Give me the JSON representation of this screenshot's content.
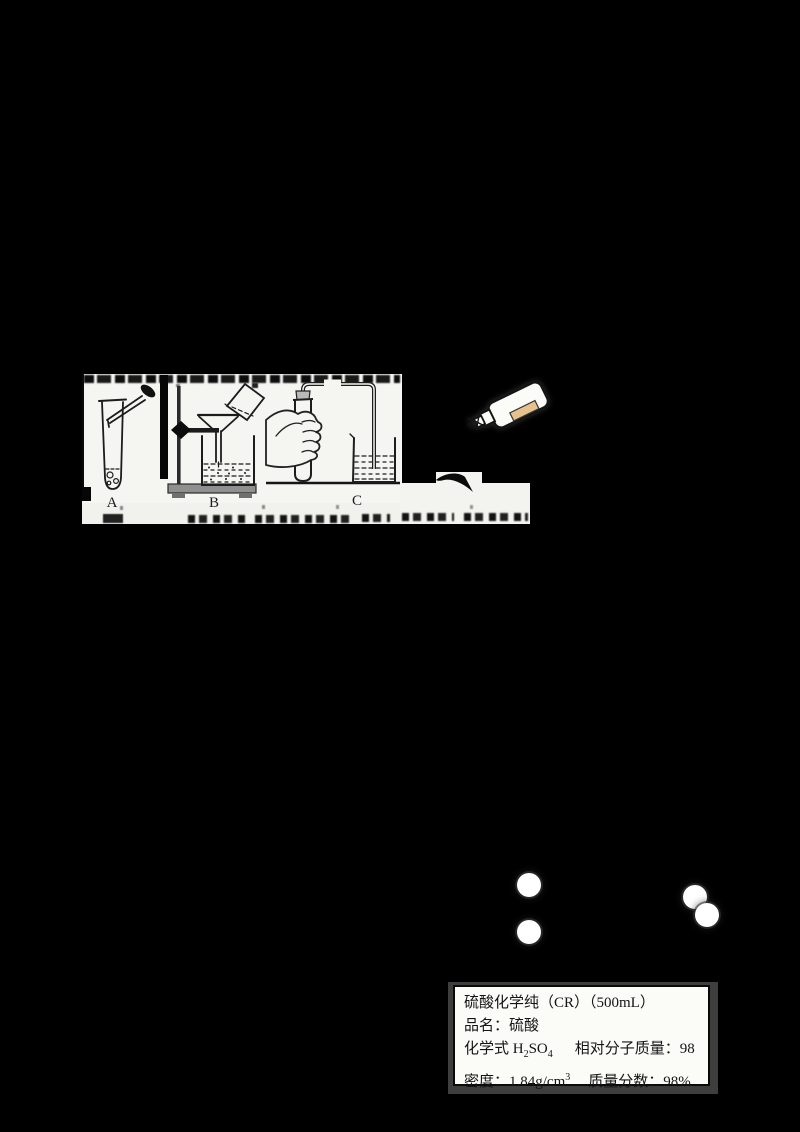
{
  "canvas": {
    "width": 800,
    "height": 1132,
    "background_color": "#000000",
    "paper_color": "#f5f5f2"
  },
  "experiment_figure": {
    "apparatus": [
      {
        "label": "A",
        "icon": "test-tube-with-dropper-icon"
      },
      {
        "label": "B",
        "icon": "filtration-funnel-stand-icon"
      },
      {
        "label": "C",
        "icon": "hand-warming-test-tube-airtightness-icon"
      }
    ]
  },
  "reagent_bottle_icon": {
    "body_color": "#fbfbf7",
    "label_color": "#e8c28d",
    "outline_color": "#141414"
  },
  "molecule_diagram": {
    "atom_color": "#ffffff",
    "atom_radius": 12,
    "atoms": [
      {
        "cx": 529,
        "cy": 885
      },
      {
        "cx": 529,
        "cy": 932
      },
      {
        "cx": 695,
        "cy": 897
      },
      {
        "cx": 707,
        "cy": 915
      }
    ]
  },
  "reagent_label_box": {
    "line1": "硫酸化学纯（CR）（500mL）",
    "line2": "品名：硫酸",
    "line3": {
      "p1": "化学式 H",
      "sub1": "2",
      "p2": "SO",
      "sub2": "4",
      "p3": "相对分子质量：98"
    },
    "line4": {
      "p1": "密度：1.84g/cm",
      "sup1": "3",
      "p2": "质量分数：98%"
    }
  }
}
